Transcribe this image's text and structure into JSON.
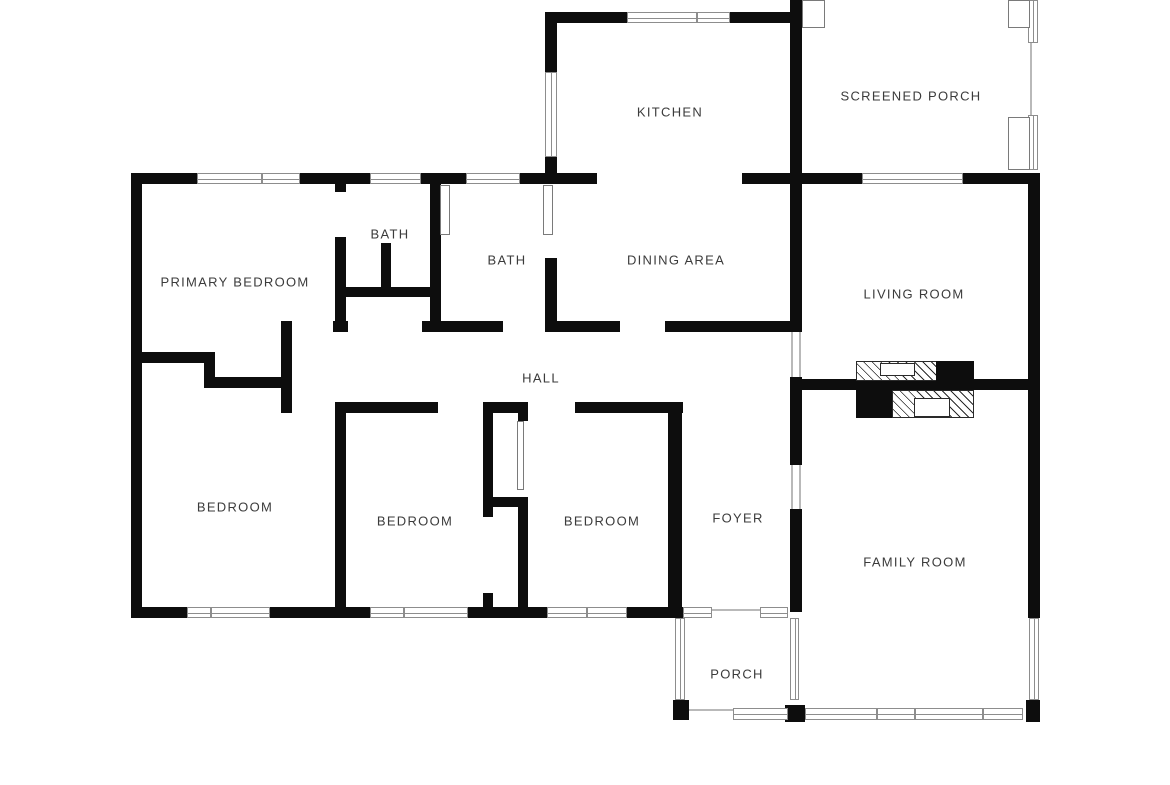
{
  "page": {
    "background": "#ffffff",
    "width": 1170,
    "height": 785
  },
  "floorplan": {
    "wall_color": "#0d0d0d",
    "window_border_color": "#8d8d8d",
    "label_color": "#3b3b3b",
    "walls": [
      [
        131,
        173,
        66,
        11
      ],
      [
        300,
        173,
        70,
        11
      ],
      [
        421,
        173,
        45,
        11
      ],
      [
        520,
        173,
        77,
        11
      ],
      [
        742,
        173,
        60,
        11
      ],
      [
        802,
        173,
        60,
        11
      ],
      [
        963,
        173,
        77,
        11
      ],
      [
        548,
        12,
        79,
        11
      ],
      [
        730,
        12,
        72,
        11
      ],
      [
        545,
        12,
        12,
        60
      ],
      [
        545,
        157,
        12,
        27
      ],
      [
        790,
        0,
        12,
        184
      ],
      [
        790,
        184,
        12,
        148
      ],
      [
        790,
        377,
        12,
        88
      ],
      [
        790,
        509,
        12,
        103
      ],
      [
        131,
        173,
        11,
        445
      ],
      [
        333,
        321,
        15,
        11
      ],
      [
        422,
        321,
        81,
        11
      ],
      [
        548,
        321,
        72,
        11
      ],
      [
        665,
        321,
        137,
        11
      ],
      [
        335,
        402,
        103,
        11
      ],
      [
        483,
        402,
        45,
        11
      ],
      [
        575,
        402,
        108,
        11
      ],
      [
        281,
        321,
        11,
        92
      ],
      [
        142,
        352,
        73,
        11
      ],
      [
        204,
        352,
        11,
        36
      ],
      [
        215,
        377,
        77,
        11
      ],
      [
        335,
        184,
        11,
        8
      ],
      [
        335,
        237,
        11,
        90
      ],
      [
        343,
        287,
        87,
        10
      ],
      [
        381,
        243,
        10,
        54
      ],
      [
        430,
        184,
        11,
        148
      ],
      [
        545,
        258,
        12,
        74
      ],
      [
        335,
        402,
        11,
        216
      ],
      [
        483,
        413,
        10,
        104
      ],
      [
        483,
        593,
        10,
        25
      ],
      [
        492,
        497,
        36,
        10
      ],
      [
        518,
        497,
        10,
        121
      ],
      [
        518,
        413,
        10,
        8
      ],
      [
        668,
        406,
        14,
        212
      ],
      [
        131,
        607,
        56,
        11
      ],
      [
        270,
        607,
        100,
        11
      ],
      [
        468,
        607,
        79,
        11
      ],
      [
        627,
        607,
        56,
        11
      ],
      [
        798,
        379,
        230,
        11
      ],
      [
        1028,
        173,
        12,
        445
      ],
      [
        785,
        705,
        20,
        17
      ],
      [
        673,
        700,
        16,
        20
      ],
      [
        1026,
        700,
        14,
        22
      ]
    ],
    "windows": [
      [
        197,
        173,
        65,
        11,
        "h"
      ],
      [
        262,
        173,
        38,
        11,
        "h"
      ],
      [
        370,
        173,
        51,
        11,
        "h"
      ],
      [
        466,
        173,
        54,
        11,
        "h"
      ],
      [
        627,
        12,
        70,
        11,
        "h"
      ],
      [
        697,
        12,
        33,
        11,
        "h"
      ],
      [
        545,
        72,
        12,
        85,
        "v"
      ],
      [
        862,
        173,
        101,
        11,
        "h"
      ],
      [
        1028,
        0,
        10,
        43,
        "v"
      ],
      [
        1028,
        115,
        10,
        55,
        "v"
      ],
      [
        187,
        607,
        24,
        11,
        "h"
      ],
      [
        211,
        607,
        59,
        11,
        "h"
      ],
      [
        370,
        607,
        34,
        11,
        "h"
      ],
      [
        404,
        607,
        64,
        11,
        "h"
      ],
      [
        547,
        607,
        40,
        11,
        "h"
      ],
      [
        587,
        607,
        40,
        11,
        "h"
      ],
      [
        683,
        607,
        29,
        11,
        "h"
      ],
      [
        760,
        607,
        28,
        11,
        "h"
      ],
      [
        675,
        618,
        10,
        82,
        "v"
      ],
      [
        790,
        618,
        9,
        82,
        "v"
      ],
      [
        733,
        708,
        55,
        12,
        "h"
      ],
      [
        805,
        708,
        72,
        12,
        "h"
      ],
      [
        877,
        708,
        38,
        12,
        "h"
      ],
      [
        915,
        708,
        68,
        12,
        "h"
      ],
      [
        983,
        708,
        40,
        12,
        "h"
      ],
      [
        1029,
        618,
        10,
        82,
        "v"
      ]
    ],
    "door_leaves": [
      [
        802,
        0,
        23,
        28
      ],
      [
        1008,
        0,
        22,
        28
      ],
      [
        1008,
        117,
        22,
        53
      ],
      [
        440,
        185,
        10,
        50
      ],
      [
        543,
        185,
        10,
        50
      ],
      [
        517,
        421,
        7,
        69
      ]
    ],
    "screens": [
      [
        1030,
        43,
        2,
        72
      ],
      [
        689,
        709,
        44,
        2
      ],
      [
        712,
        609,
        48,
        2
      ],
      [
        791,
        332,
        2,
        45
      ],
      [
        799,
        332,
        2,
        45
      ],
      [
        791,
        465,
        2,
        44
      ],
      [
        799,
        465,
        2,
        44
      ]
    ],
    "fireplace": {
      "hatched": [
        [
          856,
          361,
          82,
          20
        ],
        [
          892,
          390,
          82,
          28
        ]
      ],
      "solid": [
        [
          936,
          361,
          38,
          20
        ],
        [
          856,
          390,
          36,
          28
        ]
      ],
      "inserts": [
        [
          880,
          363,
          35,
          13
        ],
        [
          914,
          398,
          36,
          19
        ]
      ]
    },
    "labels": [
      {
        "text": "KITCHEN",
        "x": 670,
        "y": 112
      },
      {
        "text": "SCREENED PORCH",
        "x": 911,
        "y": 96
      },
      {
        "text": "BATH",
        "x": 390,
        "y": 234
      },
      {
        "text": "BATH",
        "x": 507,
        "y": 260
      },
      {
        "text": "DINING AREA",
        "x": 676,
        "y": 260
      },
      {
        "text": "PRIMARY BEDROOM",
        "x": 235,
        "y": 282
      },
      {
        "text": "LIVING ROOM",
        "x": 914,
        "y": 294
      },
      {
        "text": "HALL",
        "x": 541,
        "y": 378
      },
      {
        "text": "BEDROOM",
        "x": 235,
        "y": 507
      },
      {
        "text": "BEDROOM",
        "x": 415,
        "y": 521
      },
      {
        "text": "BEDROOM",
        "x": 602,
        "y": 521
      },
      {
        "text": "FOYER",
        "x": 738,
        "y": 518
      },
      {
        "text": "FAMILY ROOM",
        "x": 915,
        "y": 562
      },
      {
        "text": "PORCH",
        "x": 737,
        "y": 674
      }
    ]
  }
}
